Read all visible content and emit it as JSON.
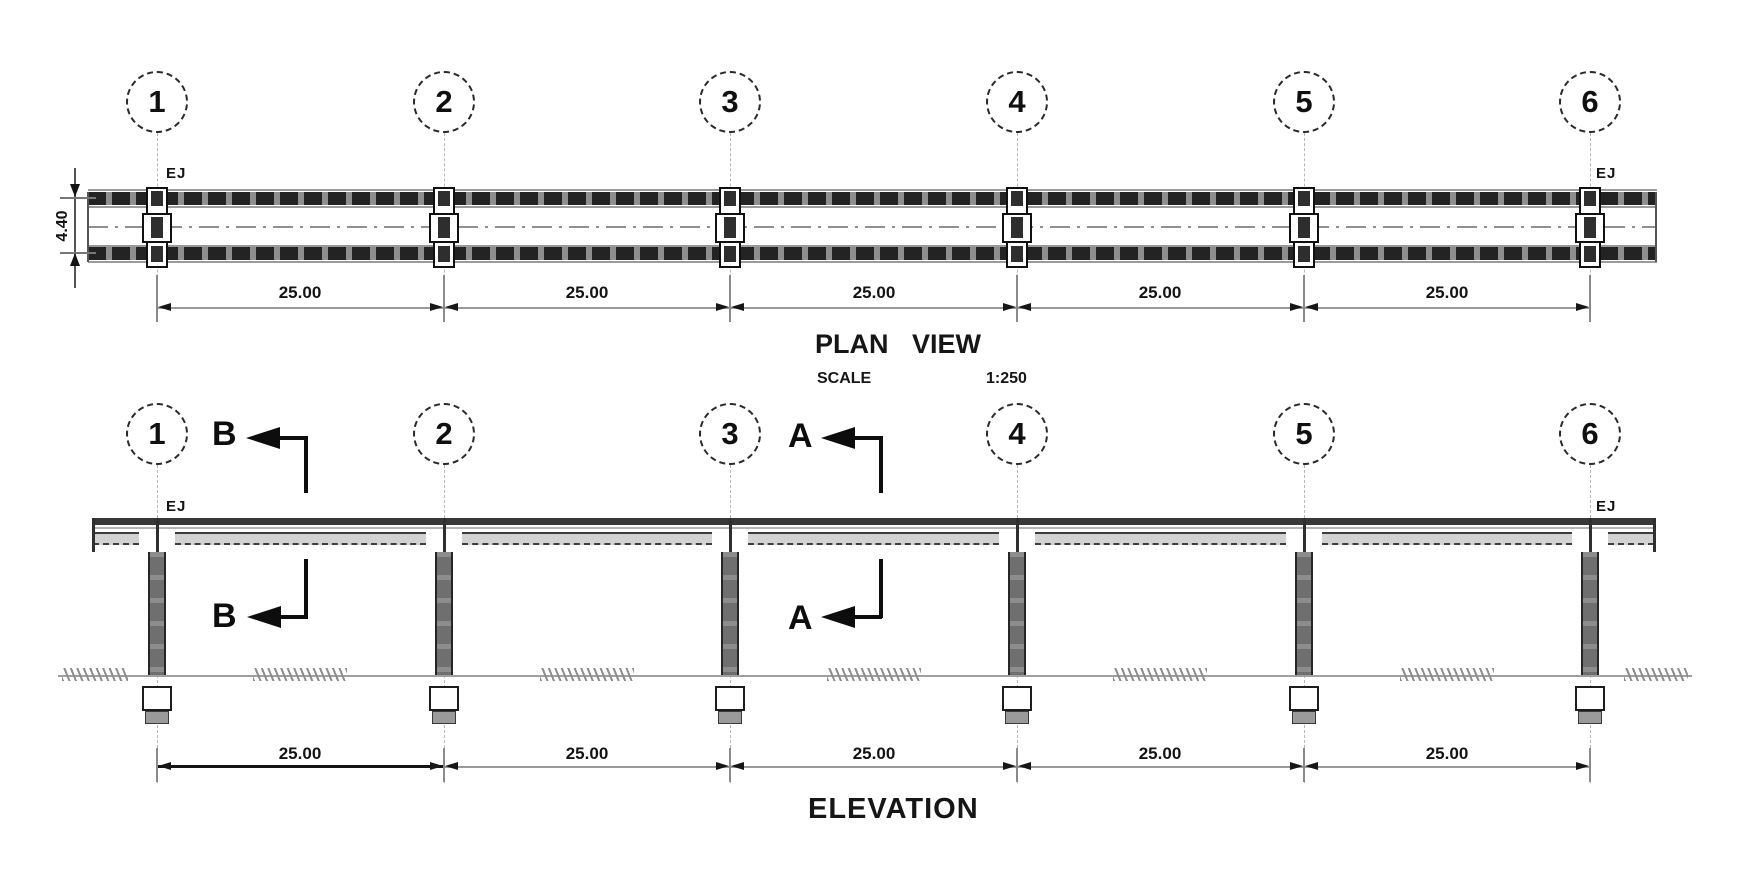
{
  "plan": {
    "title": "PLAN VIEW",
    "scale_label": "SCALE",
    "scale_value": "1:250",
    "gridline_labels": [
      "1",
      "2",
      "3",
      "4",
      "5",
      "6"
    ],
    "ej_left": "EJ",
    "ej_right": "EJ",
    "span_dimensions": [
      "25.00",
      "25.00",
      "25.00",
      "25.00",
      "25.00"
    ],
    "deck_width_dimension": "4.40"
  },
  "elevation": {
    "title": "ELEVATION",
    "gridline_labels": [
      "1",
      "2",
      "3",
      "4",
      "5",
      "6"
    ],
    "ej_left": "EJ",
    "ej_right": "EJ",
    "span_dimensions": [
      "25.00",
      "25.00",
      "25.00",
      "25.00",
      "25.00"
    ],
    "section_markers": {
      "b_top": "B",
      "b_bottom": "B",
      "a_top": "A",
      "a_bottom": "A"
    }
  },
  "colors": {
    "background": "#ffffff",
    "line_dark": "#1a1a1a",
    "line_gray": "#8f8f8f",
    "deck_fill_dark": "#2f2f2f",
    "column_fill": "#7a7a7a",
    "girder_fill": "#d2d2d2"
  }
}
